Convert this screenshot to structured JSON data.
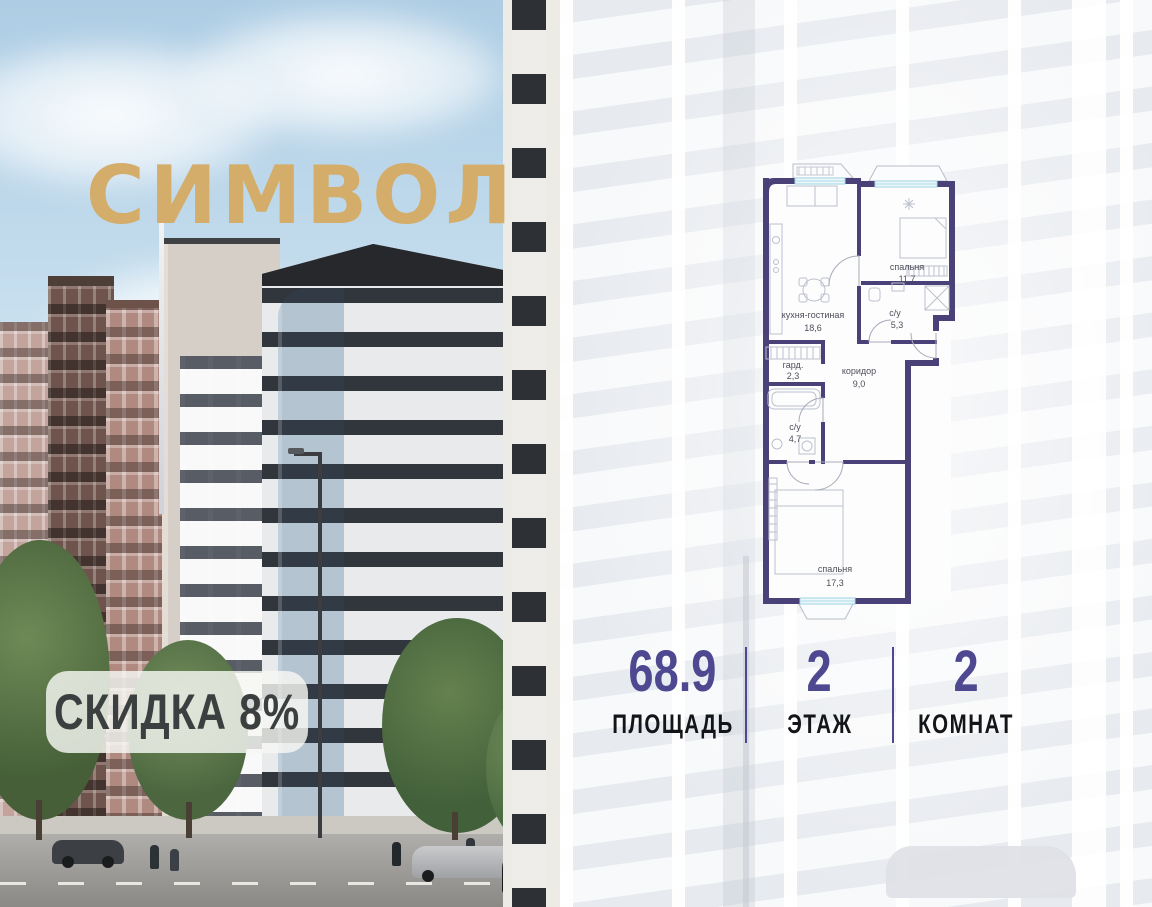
{
  "brand": {
    "logo_text": "СИМВОЛ",
    "logo_color": "#d3ad69"
  },
  "discount_badge": {
    "label": "СКИДКА 8%"
  },
  "floor_plan": {
    "wall_color": "#494177",
    "rooms": [
      {
        "name": "спальня",
        "area": "11,7"
      },
      {
        "name": "с/у",
        "area": "5,3"
      },
      {
        "name": "кухня-гостиная",
        "area": "18,6"
      },
      {
        "name": "гард.",
        "area": "2,3"
      },
      {
        "name": "коридор",
        "area": "9,0"
      },
      {
        "name": "с/у",
        "area": "4,7"
      },
      {
        "name": "спальня",
        "area": "17,3"
      }
    ]
  },
  "stats": [
    {
      "value": "68.9",
      "label": "ПЛОЩАДЬ"
    },
    {
      "value": "2",
      "label": "ЭТАЖ"
    },
    {
      "value": "2",
      "label": "КОМНАТ"
    }
  ],
  "accent_color": "#4e4890"
}
